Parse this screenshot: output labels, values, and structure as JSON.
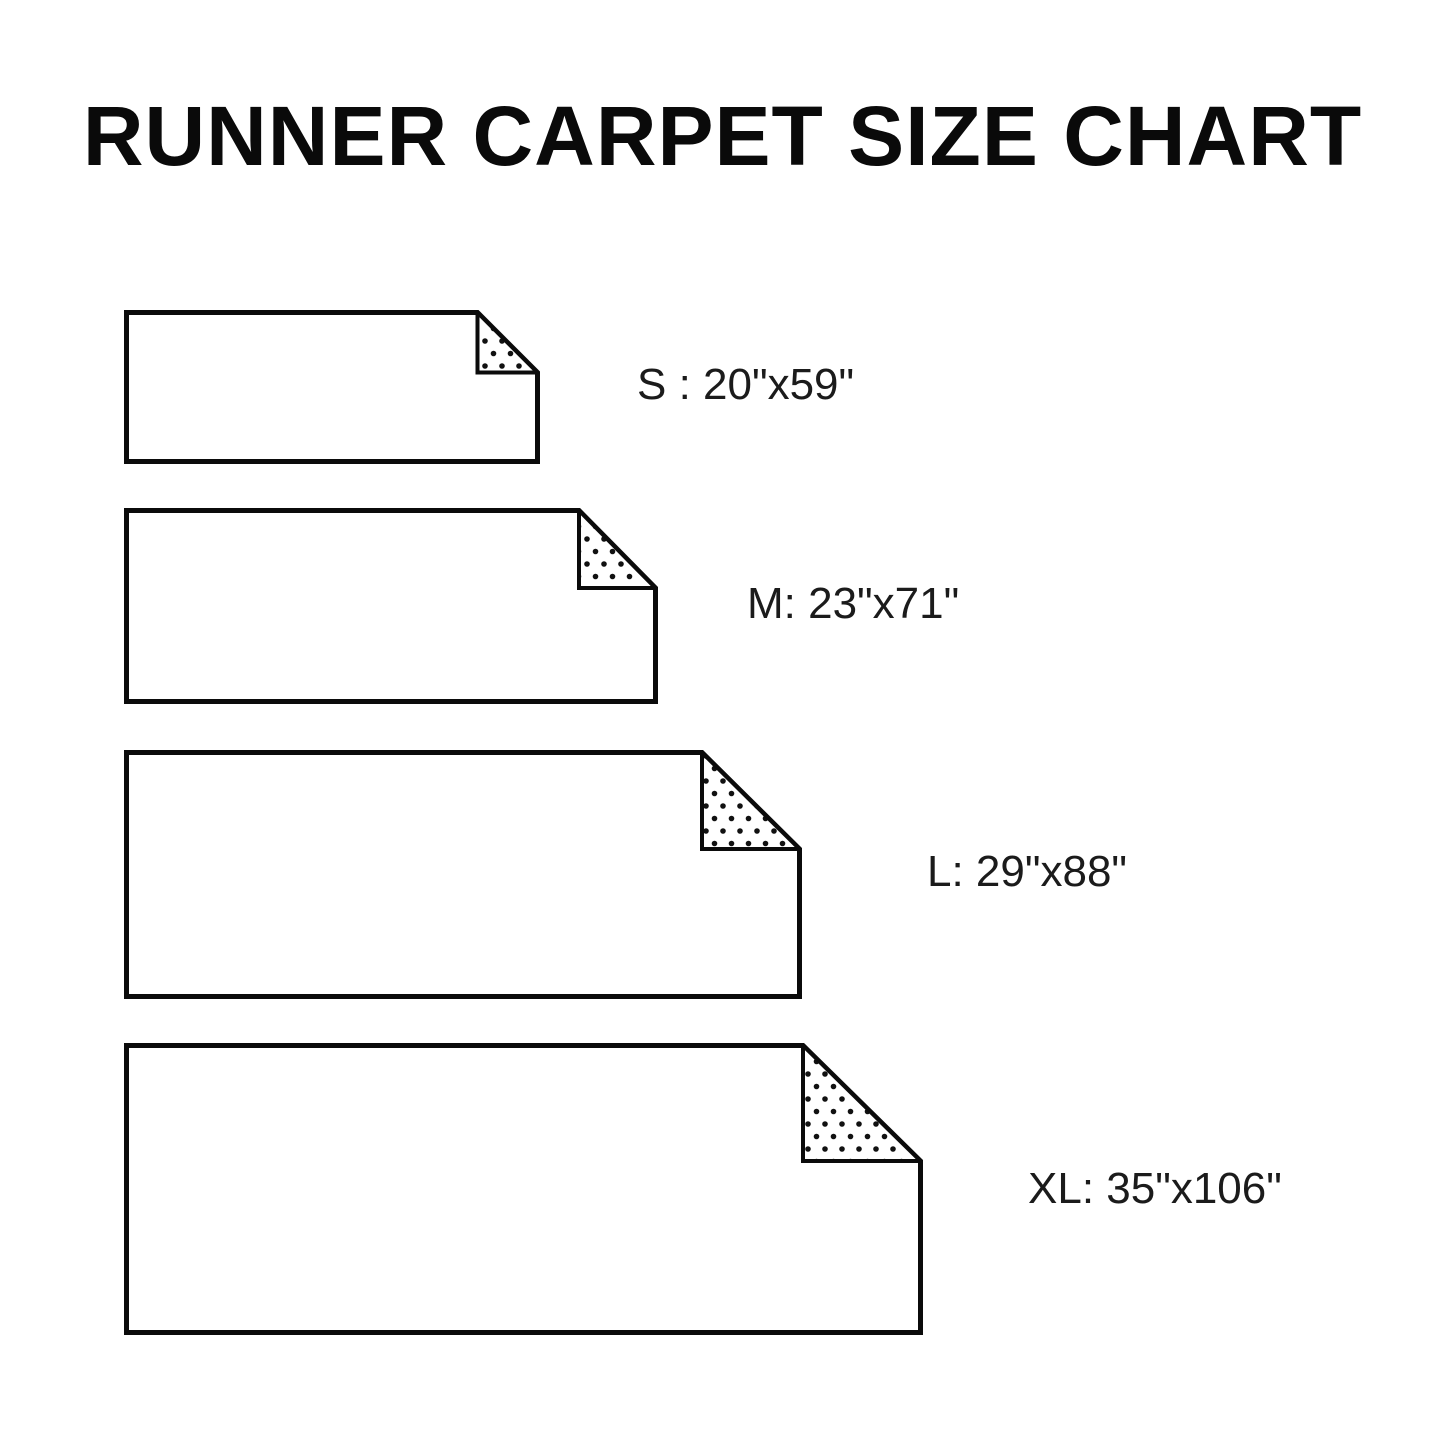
{
  "title": "RUNNER CARPET SIZE CHART",
  "colors": {
    "ink": "#0b0b0b",
    "label_text": "#1b1b1b",
    "background": "#ffffff"
  },
  "rugs": [
    {
      "size": "S",
      "label": "S : 20\"x59\"",
      "width_in": "20\"",
      "length_in": "59\""
    },
    {
      "size": "M",
      "label": "M: 23\"x71\"",
      "width_in": "23\"",
      "length_in": "71\""
    },
    {
      "size": "L",
      "label": "L: 29\"x88\"",
      "width_in": "29\"",
      "length_in": "88\""
    },
    {
      "size": "XL",
      "label": "XL: 35\"x106\"",
      "width_in": "35\"",
      "length_in": "106\""
    }
  ],
  "chart_data": {
    "type": "table",
    "title": "RUNNER CARPET SIZE CHART",
    "categories": [
      "S",
      "M",
      "L",
      "XL"
    ],
    "values_inches": [
      [
        20,
        59
      ],
      [
        23,
        71
      ],
      [
        29,
        88
      ],
      [
        35,
        106
      ]
    ],
    "unit": "inches"
  }
}
